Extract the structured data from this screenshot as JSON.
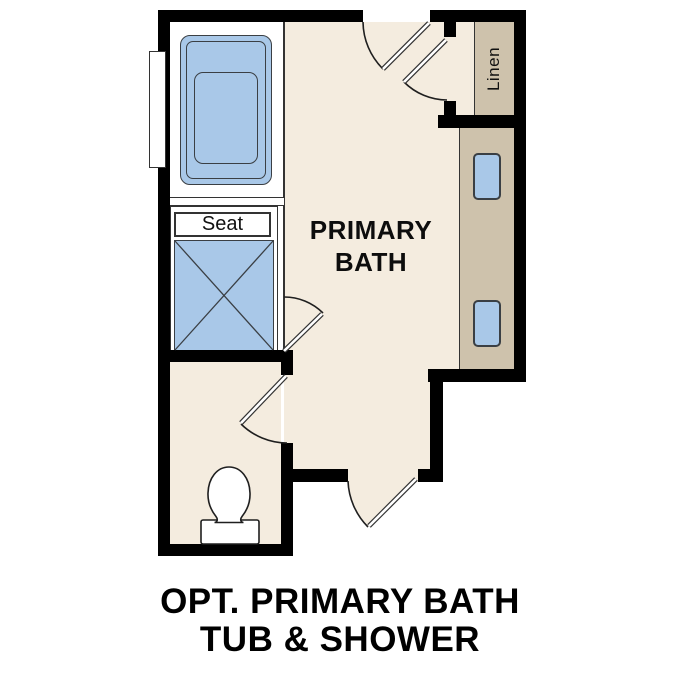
{
  "floor_plan": {
    "room_label_lines": [
      "PRIMARY",
      "BATH"
    ],
    "labels": {
      "seat": "Seat",
      "linen": "Linen"
    },
    "icons": [
      "bathtub-icon",
      "shower-icon",
      "toilet-icon",
      "sink-icon",
      "door-swing-icon",
      "window-icon"
    ],
    "colors": {
      "wall": "#000000",
      "floor": "#f4ecdf",
      "cabinet_tan": "#cec2ac",
      "fixture_blue": "#a9c8e8",
      "outline": "#3a3f44"
    }
  },
  "caption": {
    "lines": [
      "OPT. PRIMARY BATH",
      "TUB & SHOWER"
    ]
  }
}
